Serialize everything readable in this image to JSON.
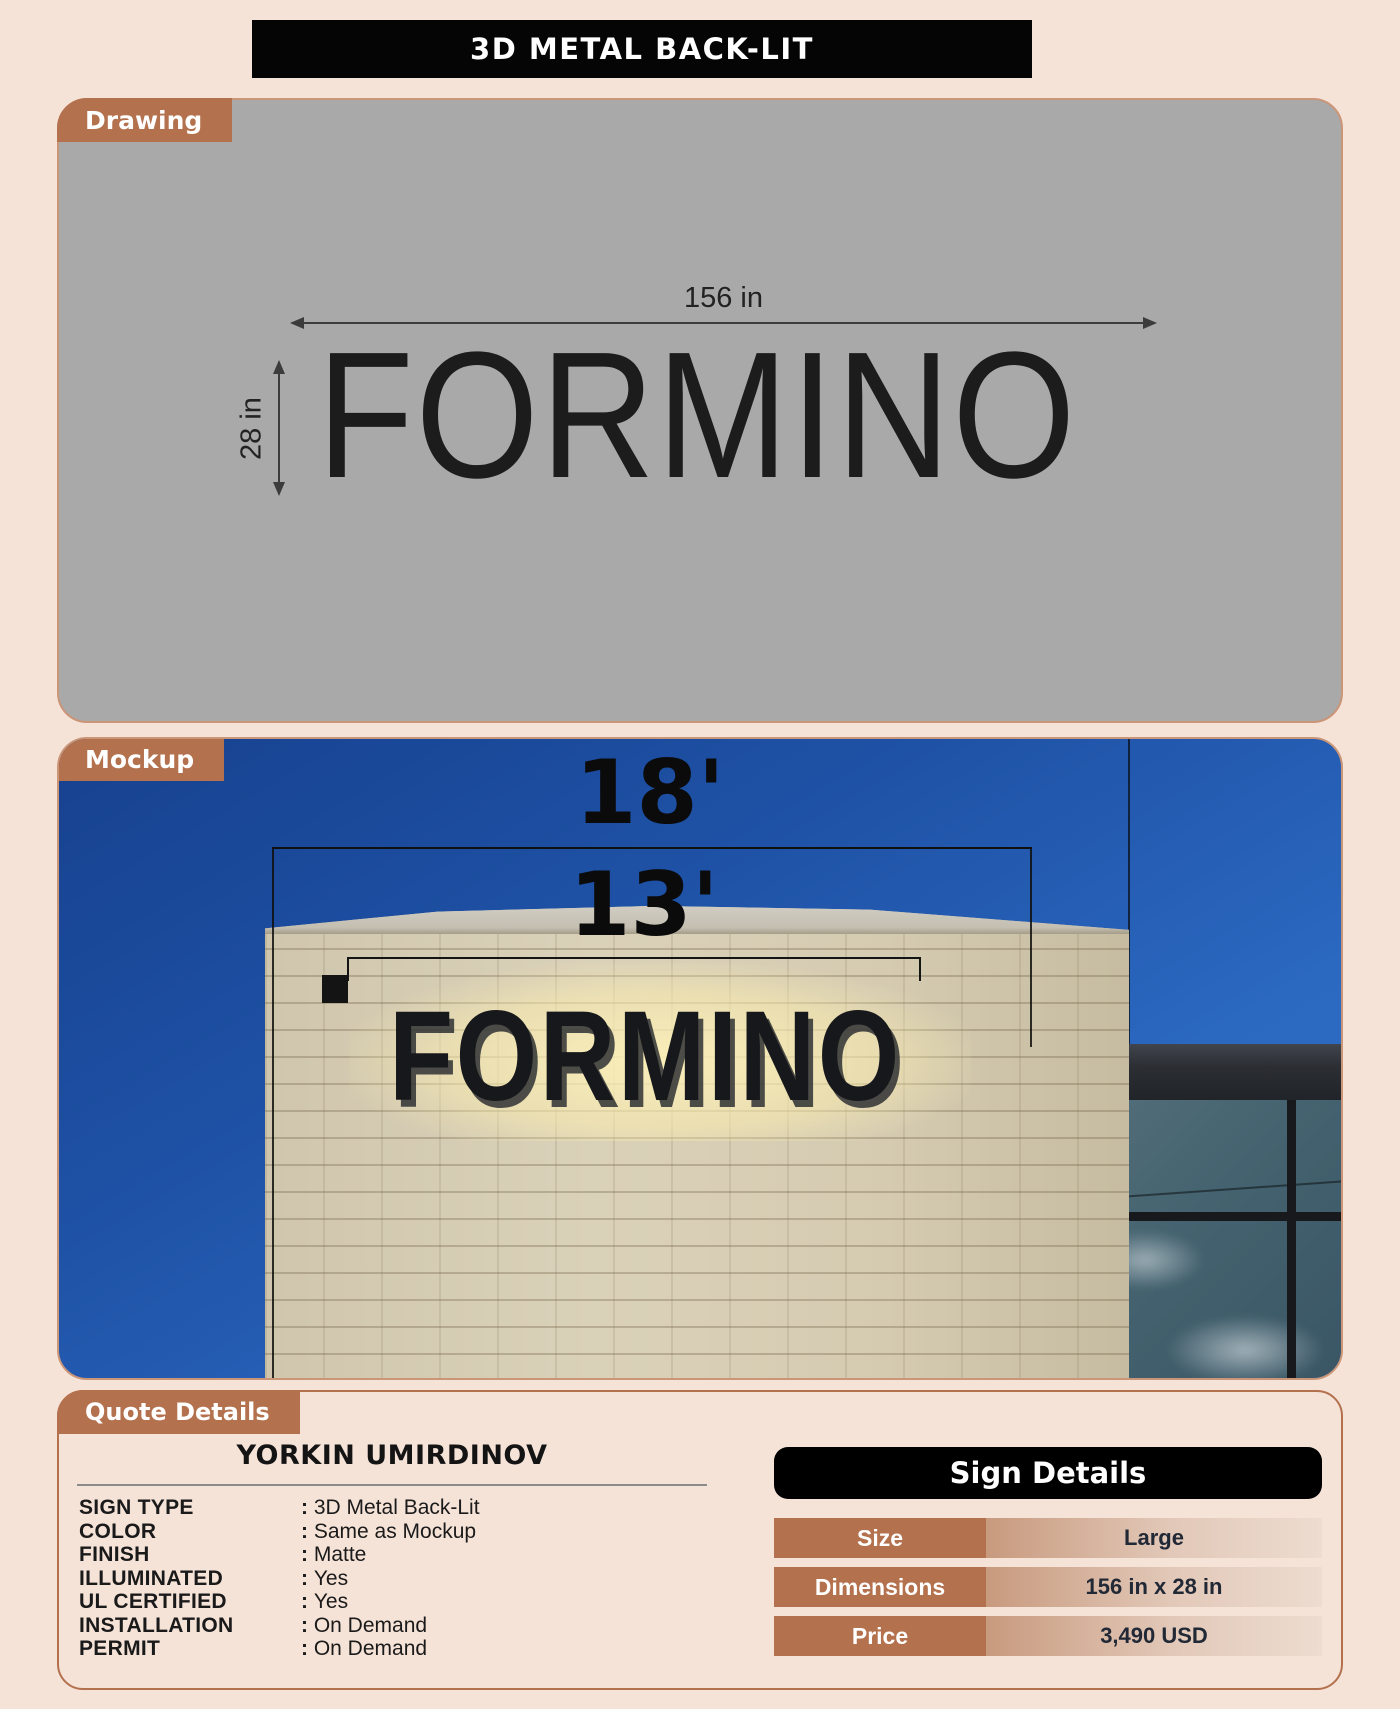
{
  "page": {
    "title": "3D METAL BACK-LIT",
    "background_color": "#f6e3d8",
    "accent_color": "#b3714e",
    "header_color": "#050505"
  },
  "drawing": {
    "tab_label": "Drawing",
    "sign_text": "FORMINO",
    "width_dimension": "156 in",
    "height_dimension": "28 in"
  },
  "mockup": {
    "tab_label": "Mockup",
    "sign_text": "FORMINO",
    "building_width_dimension": "18'",
    "sign_width_dimension": "13'"
  },
  "quote": {
    "tab_label": "Quote Details",
    "customer_name": "YORKIN UMIRDINOV",
    "fields": [
      {
        "label": "SIGN TYPE",
        "value": "3D Metal Back-Lit"
      },
      {
        "label": "COLOR",
        "value": "Same as Mockup"
      },
      {
        "label": "FINISH",
        "value": "Matte"
      },
      {
        "label": "ILLUMINATED",
        "value": "Yes"
      },
      {
        "label": "UL CERTIFIED",
        "value": "Yes"
      },
      {
        "label": "INSTALLATION",
        "value": "On Demand"
      },
      {
        "label": "PERMIT",
        "value": "On Demand"
      }
    ]
  },
  "sign_details": {
    "title": "Sign Details",
    "rows": [
      {
        "label": "Size",
        "value": "Large"
      },
      {
        "label": "Dimensions",
        "value": "156 in x 28 in"
      },
      {
        "label": "Price",
        "value": "3,490 USD"
      }
    ]
  }
}
